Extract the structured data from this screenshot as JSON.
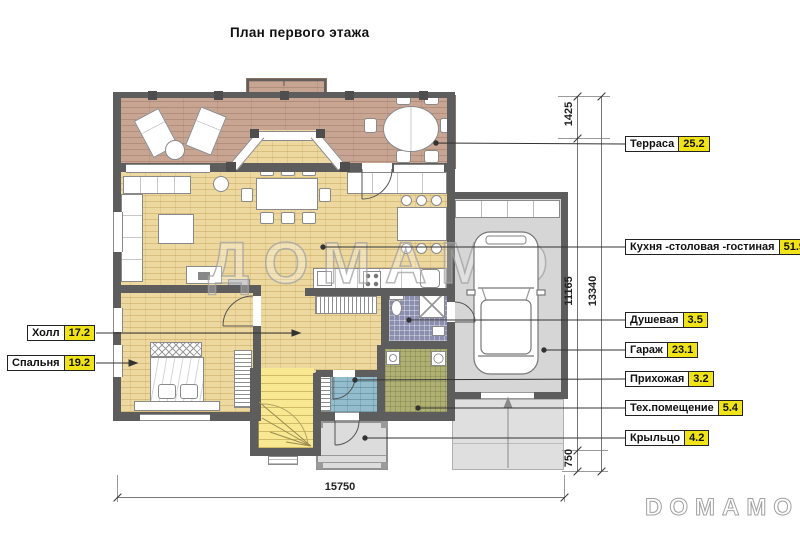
{
  "title": "План первого этажа",
  "watermark_center": "ДОМАМО",
  "watermark_logo": "DOMAMO",
  "rooms": [
    {
      "name": "Терраса",
      "area": "25.2"
    },
    {
      "name": "Кухня -столовая -гостиная",
      "area": "51.9"
    },
    {
      "name": "Душевая",
      "area": "3.5"
    },
    {
      "name": "Гараж",
      "area": "23.1"
    },
    {
      "name": "Прихожая",
      "area": "3.2"
    },
    {
      "name": "Тех.помещение",
      "area": "5.4"
    },
    {
      "name": "Крыльцо",
      "area": "4.2"
    },
    {
      "name": "Холл",
      "area": "17.2"
    },
    {
      "name": "Спальня",
      "area": "19.2"
    }
  ],
  "dimensions": {
    "terrace_depth": "1425",
    "house_depth": "11165",
    "total_depth": "13340",
    "porch_depth": "750",
    "total_width": "15750"
  },
  "colors": {
    "area_highlight": "#f0e418",
    "wall": "#5d5d5d",
    "terrace_floor": "#c8a593",
    "main_floor": "#edd9a0",
    "shower_floor": "#8b8eae",
    "tech_floor": "#afb172",
    "hallway_floor": "#93bccc",
    "garage_floor": "#d6d6d6"
  }
}
